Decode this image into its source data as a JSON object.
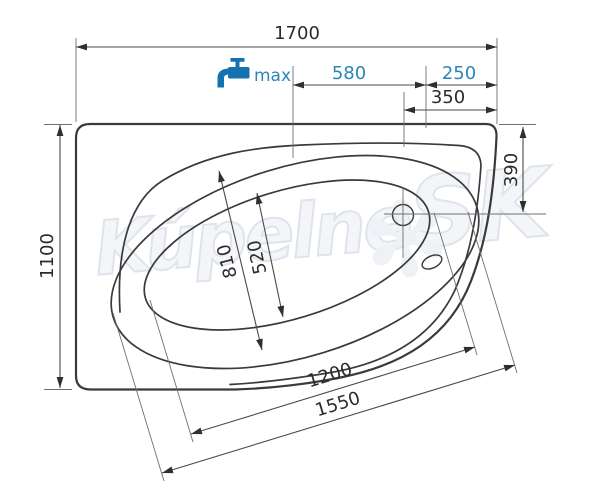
{
  "drawing": {
    "subject": "asymmetric-corner-bathtub-top-view"
  },
  "watermark": {
    "text": "Kúpelne",
    "suffix": "SK",
    "flower": "✻",
    "color": "#dfe4ec"
  },
  "tap": {
    "label": "max",
    "icon": "faucet-icon",
    "color": "#1572b0"
  },
  "colors": {
    "line_main": "#3a3a3a",
    "line_thin": "#6f6f6f",
    "dim_text": "#2b2b2b",
    "accent_blue": "#2b86b6"
  },
  "dimensions": {
    "overall_length": "1700",
    "overall_width": "1100",
    "tap_zone_length": "580",
    "tap_zone_edge_offset": "250",
    "drain_offset_from_edge": "350",
    "drain_offset_from_top": "390",
    "rim_opening_width": "810",
    "basin_width": "520",
    "basin_length": "1200",
    "rim_opening_length": "1550"
  }
}
